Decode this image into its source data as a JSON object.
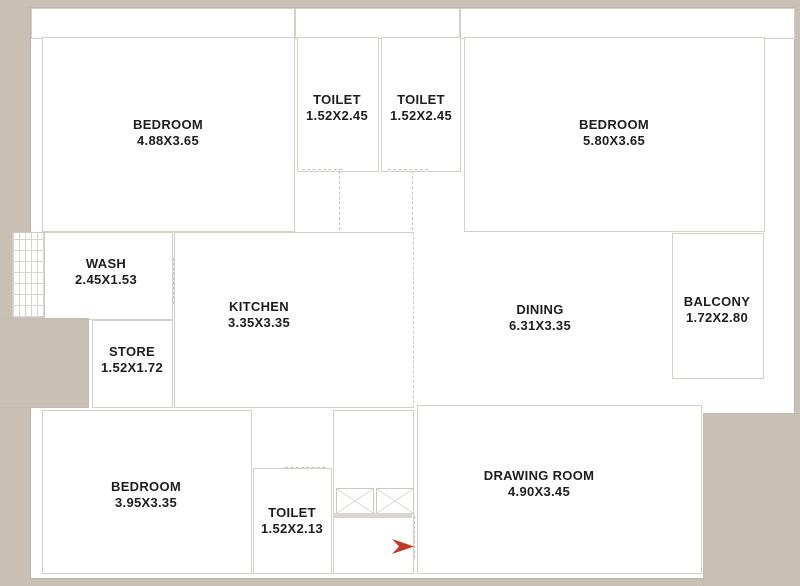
{
  "page": {
    "background_color": "#c9c0b5",
    "plan_color": "#ffffff",
    "wall_line_color": "#d5cfc7",
    "text_color": "#1e1e1e",
    "entry_arrow_color": "#c23a26"
  },
  "rooms": [
    {
      "id": "bedroom-top-left",
      "name": "BEDROOM",
      "dims": "4.88X3.65"
    },
    {
      "id": "toilet-top-left",
      "name": "TOILET",
      "dims": "1.52X2.45"
    },
    {
      "id": "toilet-top-right",
      "name": "TOILET",
      "dims": "1.52X2.45"
    },
    {
      "id": "bedroom-top-right",
      "name": "BEDROOM",
      "dims": "5.80X3.65"
    },
    {
      "id": "wash",
      "name": "WASH",
      "dims": "2.45X1.53"
    },
    {
      "id": "kitchen",
      "name": "KITCHEN",
      "dims": "3.35X3.35"
    },
    {
      "id": "store",
      "name": "STORE",
      "dims": "1.52X1.72"
    },
    {
      "id": "dining",
      "name": "DINING",
      "dims": "6.31X3.35"
    },
    {
      "id": "balcony",
      "name": "BALCONY",
      "dims": "1.72X2.80"
    },
    {
      "id": "bedroom-bottom-left",
      "name": "BEDROOM",
      "dims": "3.95X3.35"
    },
    {
      "id": "toilet-bottom",
      "name": "TOILET",
      "dims": "1.52X2.13"
    },
    {
      "id": "drawing-room",
      "name": "DRAWING ROOM",
      "dims": "4.90X3.45"
    }
  ],
  "icons": {
    "entry_arrow": "entry-direction-marker",
    "shaft_boxes": "crossed-shaft-symbol"
  }
}
